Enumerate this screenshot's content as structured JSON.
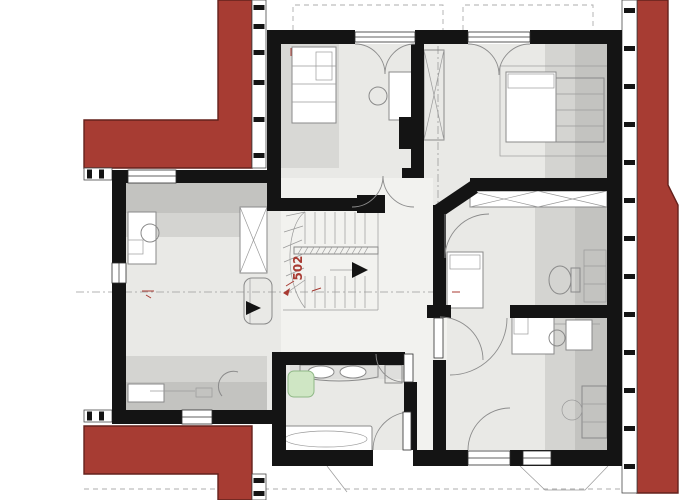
{
  "labels": {
    "stair_dimension": "502"
  },
  "colors": {
    "roof": "#a73c33",
    "roof_outline": "#64211c",
    "wall": "#141414",
    "floor": "#e9e9e6",
    "floor_light": "#f2f2ef",
    "shade_a": "#c3c3c0",
    "shade_b": "#d4d4d1",
    "furniture_stroke": "#8a8a8a",
    "bench_fill": "#cfe6c4",
    "bench_stroke": "#8fb886",
    "dash": "#aeaeae",
    "label_red": "#a83a32"
  }
}
